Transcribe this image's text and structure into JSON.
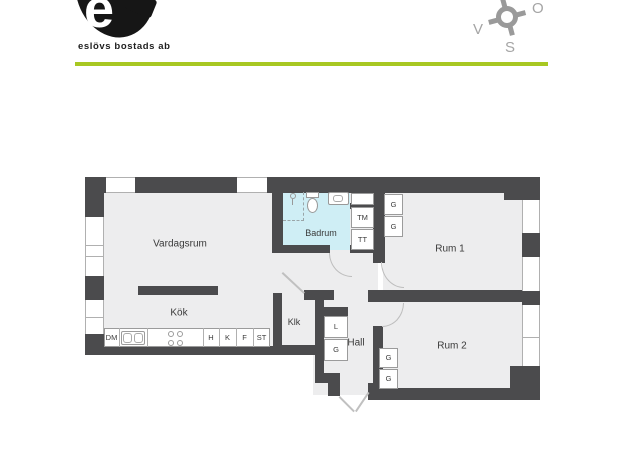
{
  "header": {
    "logo_letter": "e",
    "logo_text": "eslövs bostads ab",
    "accent_color": "#a8c822"
  },
  "compass": {
    "west": "V",
    "east": "O",
    "south": "S"
  },
  "floorplan": {
    "colors": {
      "wall": "#4b4b4d",
      "floor": "#ededee",
      "bathroom_floor": "#cfeef5"
    },
    "rooms": {
      "vardagsrum": "Vardagsrum",
      "kok": "Kök",
      "badrum": "Badrum",
      "klk": "Klk",
      "hall": "Hall",
      "rum1": "Rum 1",
      "rum2": "Rum 2"
    },
    "fixtures": {
      "dm": "DM",
      "h": "H",
      "k": "K",
      "f": "F",
      "st": "ST",
      "tm": "TM",
      "tt": "TT",
      "l": "L",
      "g": "G"
    }
  }
}
